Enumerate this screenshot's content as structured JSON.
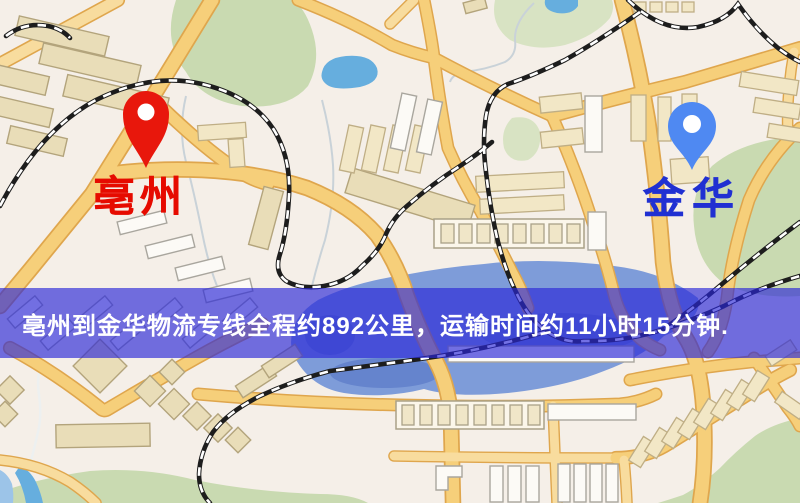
{
  "banner": {
    "text": "亳州到金华物流专线全程约892公里，运输时间约11小时15分钟.",
    "distance": "892公里",
    "duration": "11小时15分钟",
    "overlay_color": "#2a28d8",
    "text_color": "#ffffff"
  },
  "markers": {
    "origin": {
      "label": "亳州",
      "pin_color": "#e8170c",
      "label_color": "#e60b00"
    },
    "destination": {
      "label": "金华",
      "pin_color": "#4f89f2",
      "label_color": "#2030d2"
    }
  },
  "map": {
    "palette": {
      "background": "#f5efe8",
      "road_fill": "#f6cf7a",
      "road_casing": "#dfa64d",
      "minor_road": "#f8dc9e",
      "park_green": "#c9dab1",
      "water": "#7e9cd9",
      "lake": "#66aede",
      "railway": "#1d1d1d",
      "building_tan": "#e9ddb8",
      "building_white": "#fcfaf6"
    }
  }
}
